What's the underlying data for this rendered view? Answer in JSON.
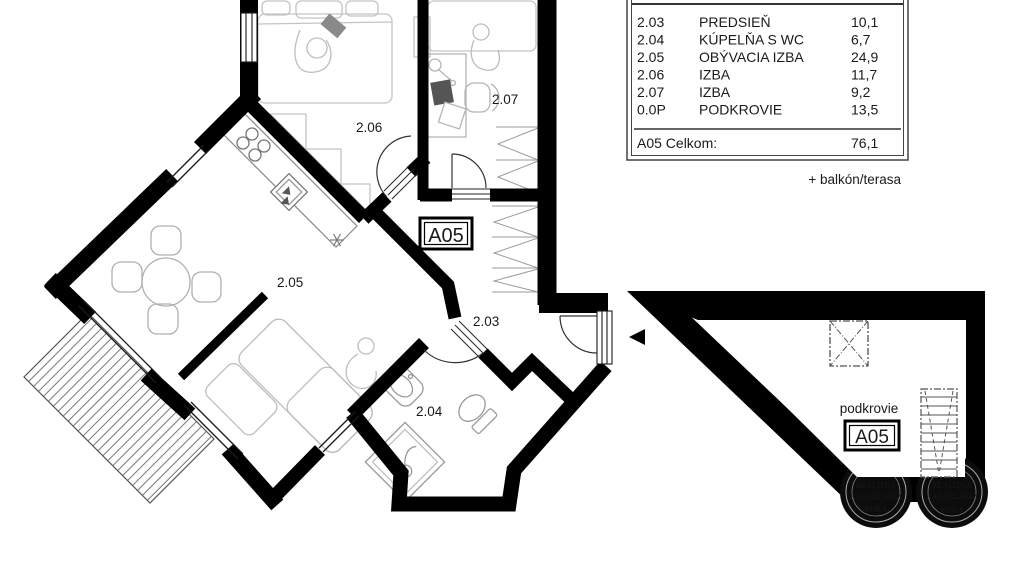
{
  "unit": {
    "id": "A05"
  },
  "legend": {
    "rows": [
      {
        "no": "2.03",
        "name": "PREDSIEŇ",
        "area": "10,1"
      },
      {
        "no": "2.04",
        "name": "KÚPELŇA S WC",
        "area": "6,7"
      },
      {
        "no": "2.05",
        "name": "OBÝVACIA IZBA",
        "area": "24,9"
      },
      {
        "no": "2.06",
        "name": "IZBA",
        "area": "11,7"
      },
      {
        "no": "2.07",
        "name": "IZBA",
        "area": "9,2"
      },
      {
        "no": "0.0P",
        "name": "PODKROVIE",
        "area": "13,5"
      }
    ],
    "total_label": "A05 Celkom:",
    "total_area": "76,1",
    "note": "+ balkón/terasa"
  },
  "plan_labels": {
    "hall": "2.03",
    "bathroom": "2.04",
    "living_room": "2.05",
    "bedroom": "2.06",
    "room2": "2.07"
  },
  "attic": {
    "caption": "podkrovie"
  },
  "watermark": {
    "line1": "REALITNÁ",
    "line2": "KANCELÁRIA",
    "line3": "ROKA"
  },
  "colors": {
    "wall": "#000000",
    "furniture": "#c4c4c4",
    "fixture": "#9a9a9a",
    "label": "#1a1a1a",
    "muted_label": "#b9b9b9"
  }
}
